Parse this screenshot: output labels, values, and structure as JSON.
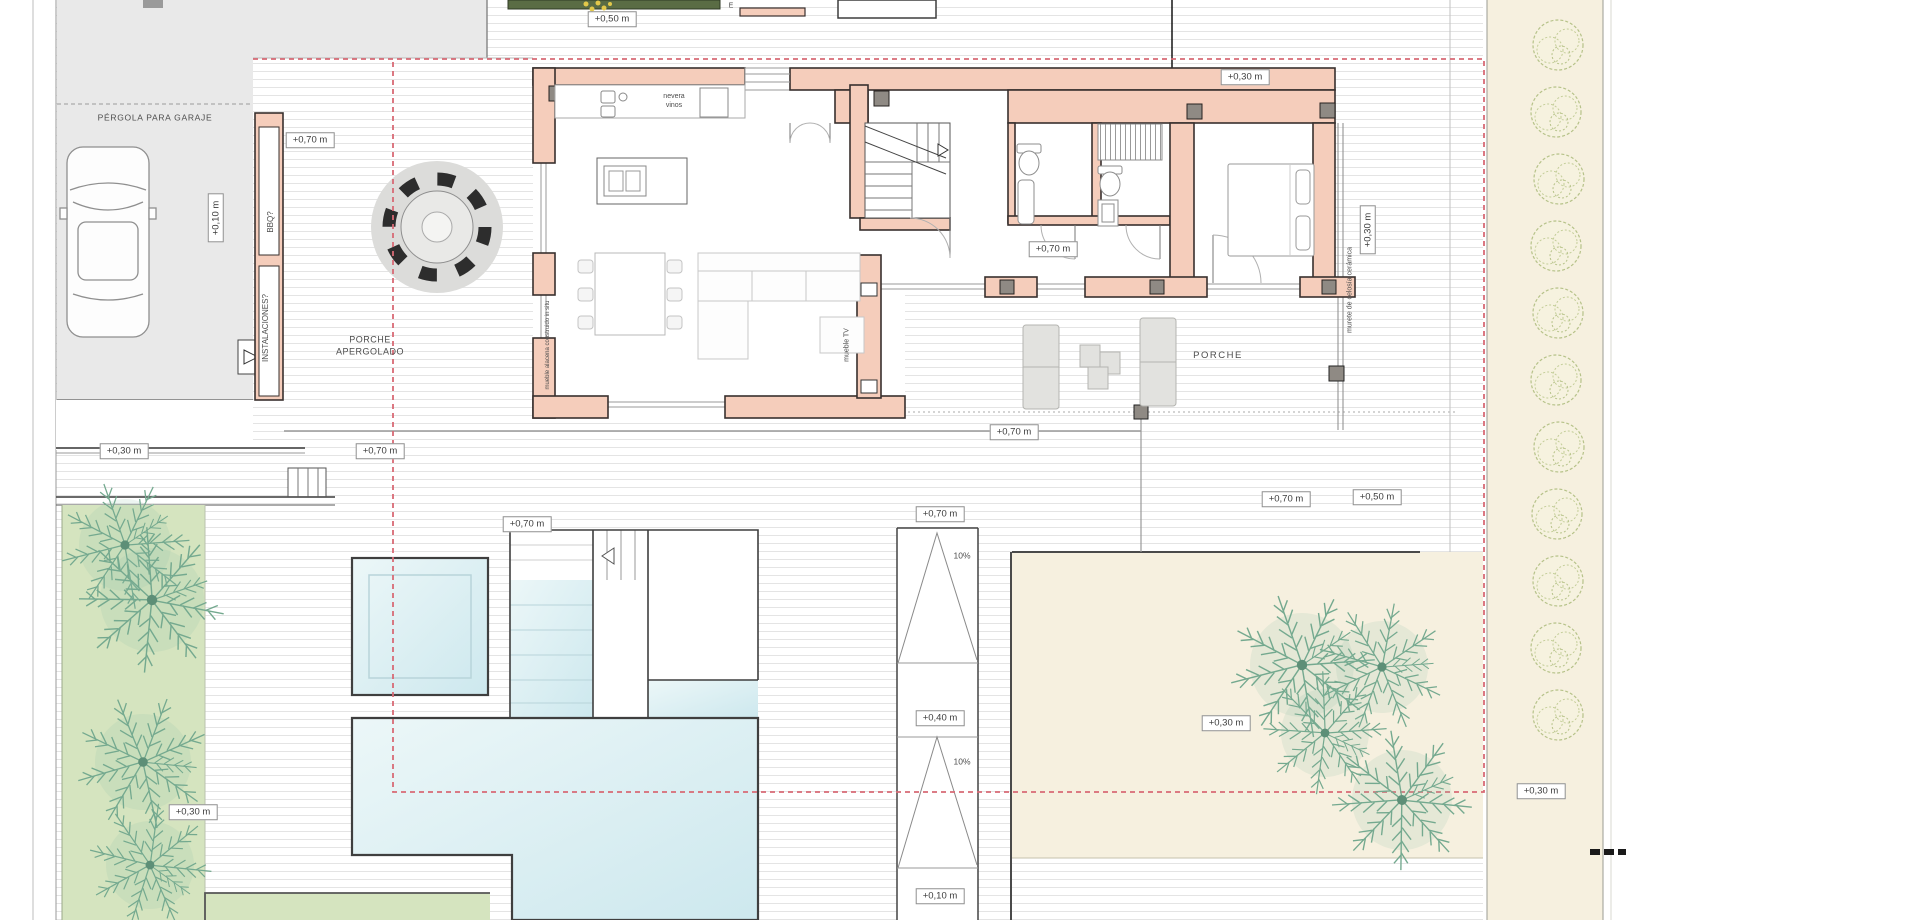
{
  "labels": {
    "pergola_garage": "PÉRGOLA PARA GARAJE",
    "porch_pergola_line1": "PORCHE",
    "porch_pergola_line2": "APERGOLADO",
    "porch_east": "PORCHE",
    "bbq": "BBQ?",
    "installations": "INSTALACIONES?",
    "wine_fridge_line1": "nevera",
    "wine_fridge_line2": "vinos",
    "tv_cabinet": "mueble TV",
    "builtin_cabinet": "mueble alacena construido in situ",
    "ceramic_lattice_wall": "murete de celosía cerámica",
    "top_edge_fragment": "E"
  },
  "levels": {
    "garage": "+0,10 m",
    "ramp_bottom": "+0,10 m",
    "walkway": "+0,30 m",
    "north_deck": "+0,30 m",
    "east_lattice": "+0,30 m",
    "garden_se": "+0,30 m",
    "garden_right_strip": "+0,30 m",
    "lawn_left": "+0,30 m",
    "ramp_mid": "+0,40 m",
    "top_planter": "+0,50 m",
    "deck_east_low": "+0,50 m",
    "porch_nw": "+0,70 m",
    "below_bbq": "+0,70 m",
    "hall": "+0,70 m",
    "porch_south": "+0,70 m",
    "deck_mid": "+0,70 m",
    "ramp_top": "+0,70 m",
    "deck_east": "+0,70 m",
    "ramp_slope_upper": "10%",
    "ramp_slope_lower": "10%"
  },
  "colors": {
    "wall_fill": "#f5cdbb",
    "wall_outline": "#38302e",
    "water": "#d9edf2",
    "lawn": "#d5e4bf",
    "garden_beige": "#f6f0df",
    "boundary_red": "#d86a75",
    "concrete_gray": "#e9e9e9",
    "palm_green": "#74a98f",
    "bush_green": "#b6c289"
  }
}
